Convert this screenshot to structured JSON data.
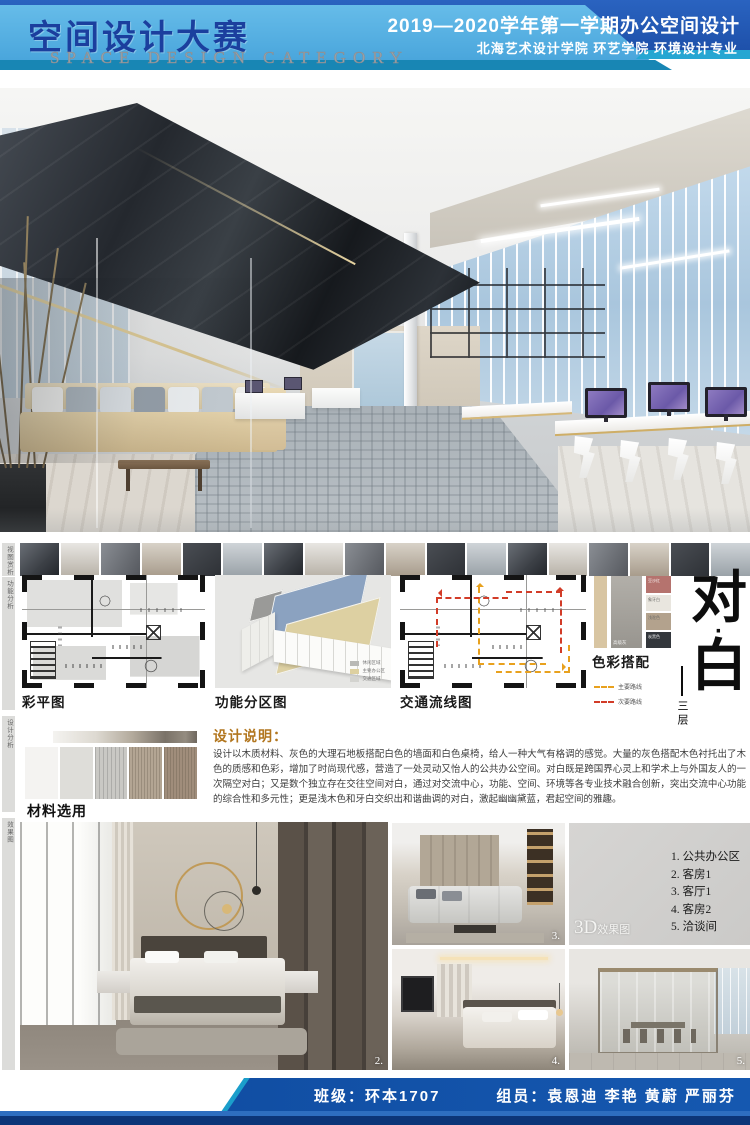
{
  "header": {
    "title": "空间设计大赛",
    "subtitle": "SPACE DESIGN CATEGORY",
    "course": "2019—2020学年第一学期办公空间设计",
    "school": "北海艺术设计学院 环艺学院 环境设计专业"
  },
  "rail": {
    "labels": [
      "视图赏析",
      "功能分析",
      "设计分析",
      "效果图"
    ]
  },
  "thumbnails": {
    "count": 18
  },
  "plans": {
    "color_plan_label": "彩平图",
    "zoning_label": "功能分区图",
    "zoning_legend": [
      {
        "label": "休闲区域",
        "color": "#b9b9b5"
      },
      {
        "label": "主要办公区",
        "color": "#ddd0a0"
      },
      {
        "label": "交通区域",
        "color": "#d3d3cf"
      }
    ],
    "flow_label": "交通流线图",
    "flow_legend": [
      {
        "label": "主要路线",
        "color": "#e8a11e",
        "dash": true
      },
      {
        "label": "次要路线",
        "color": "#d23c28",
        "dash": true
      }
    ]
  },
  "palette": {
    "label": "色彩搭配",
    "strip_color": "#d8c5a2",
    "main_name": "高级灰",
    "chips": [
      {
        "name": "豆沙红",
        "color": "#b5736e"
      },
      {
        "name": "象牙白",
        "color": "#e9e6df"
      },
      {
        "name": "浅驼色",
        "color": "#b3a28d"
      },
      {
        "name": "炭黑色",
        "color": "#33373c"
      }
    ]
  },
  "title_block": {
    "char_top": "对",
    "char_dot": "·",
    "char_bottom": "白",
    "floor": "三层"
  },
  "description": {
    "heading": "设计说明：",
    "body": "设计以木质材料、灰色的大理石地板搭配白色的墙面和白色桌椅，给人一种大气有格调的感觉。大量的灰色搭配木色衬托出了木色的质感和色彩，增加了时尚现代感，营造了一处灵动又怡人的公共办公空间。对白既是跨国界心灵上和学术上与外国友人的一次隔空对白；又是数个独立存在交往空间对白，通过对交流中心，功能、空间、环境等各专业技术融合创新，突出交流中心功能的综合性和多元性；更是浅木色和牙白交织出和谐曲调的对白，激起幽幽黛蓝，君起空间的雅趣。"
  },
  "materials": {
    "label": "材料选用",
    "swatches": [
      {
        "color": "#f4f3f1"
      },
      {
        "color": "#deddd9"
      },
      {
        "color": "#c9c8c4"
      },
      {
        "color": "#b3a593"
      },
      {
        "color": "#a08d7b"
      }
    ]
  },
  "renders": {
    "badge_3d": "3D",
    "badge_suffix": "效果图",
    "list": [
      "1. 公共办公区",
      "2. 客房1",
      "3. 客厅1",
      "4. 客房2",
      "5. 洽谈间"
    ],
    "num_big": "2.",
    "num_living": "3.",
    "num_bed2": "4.",
    "num_meeting": "5."
  },
  "footer": {
    "class_label": "班级：环本1707",
    "members": "组员：袁恩迪 李艳 黄蔚 严丽芬"
  }
}
